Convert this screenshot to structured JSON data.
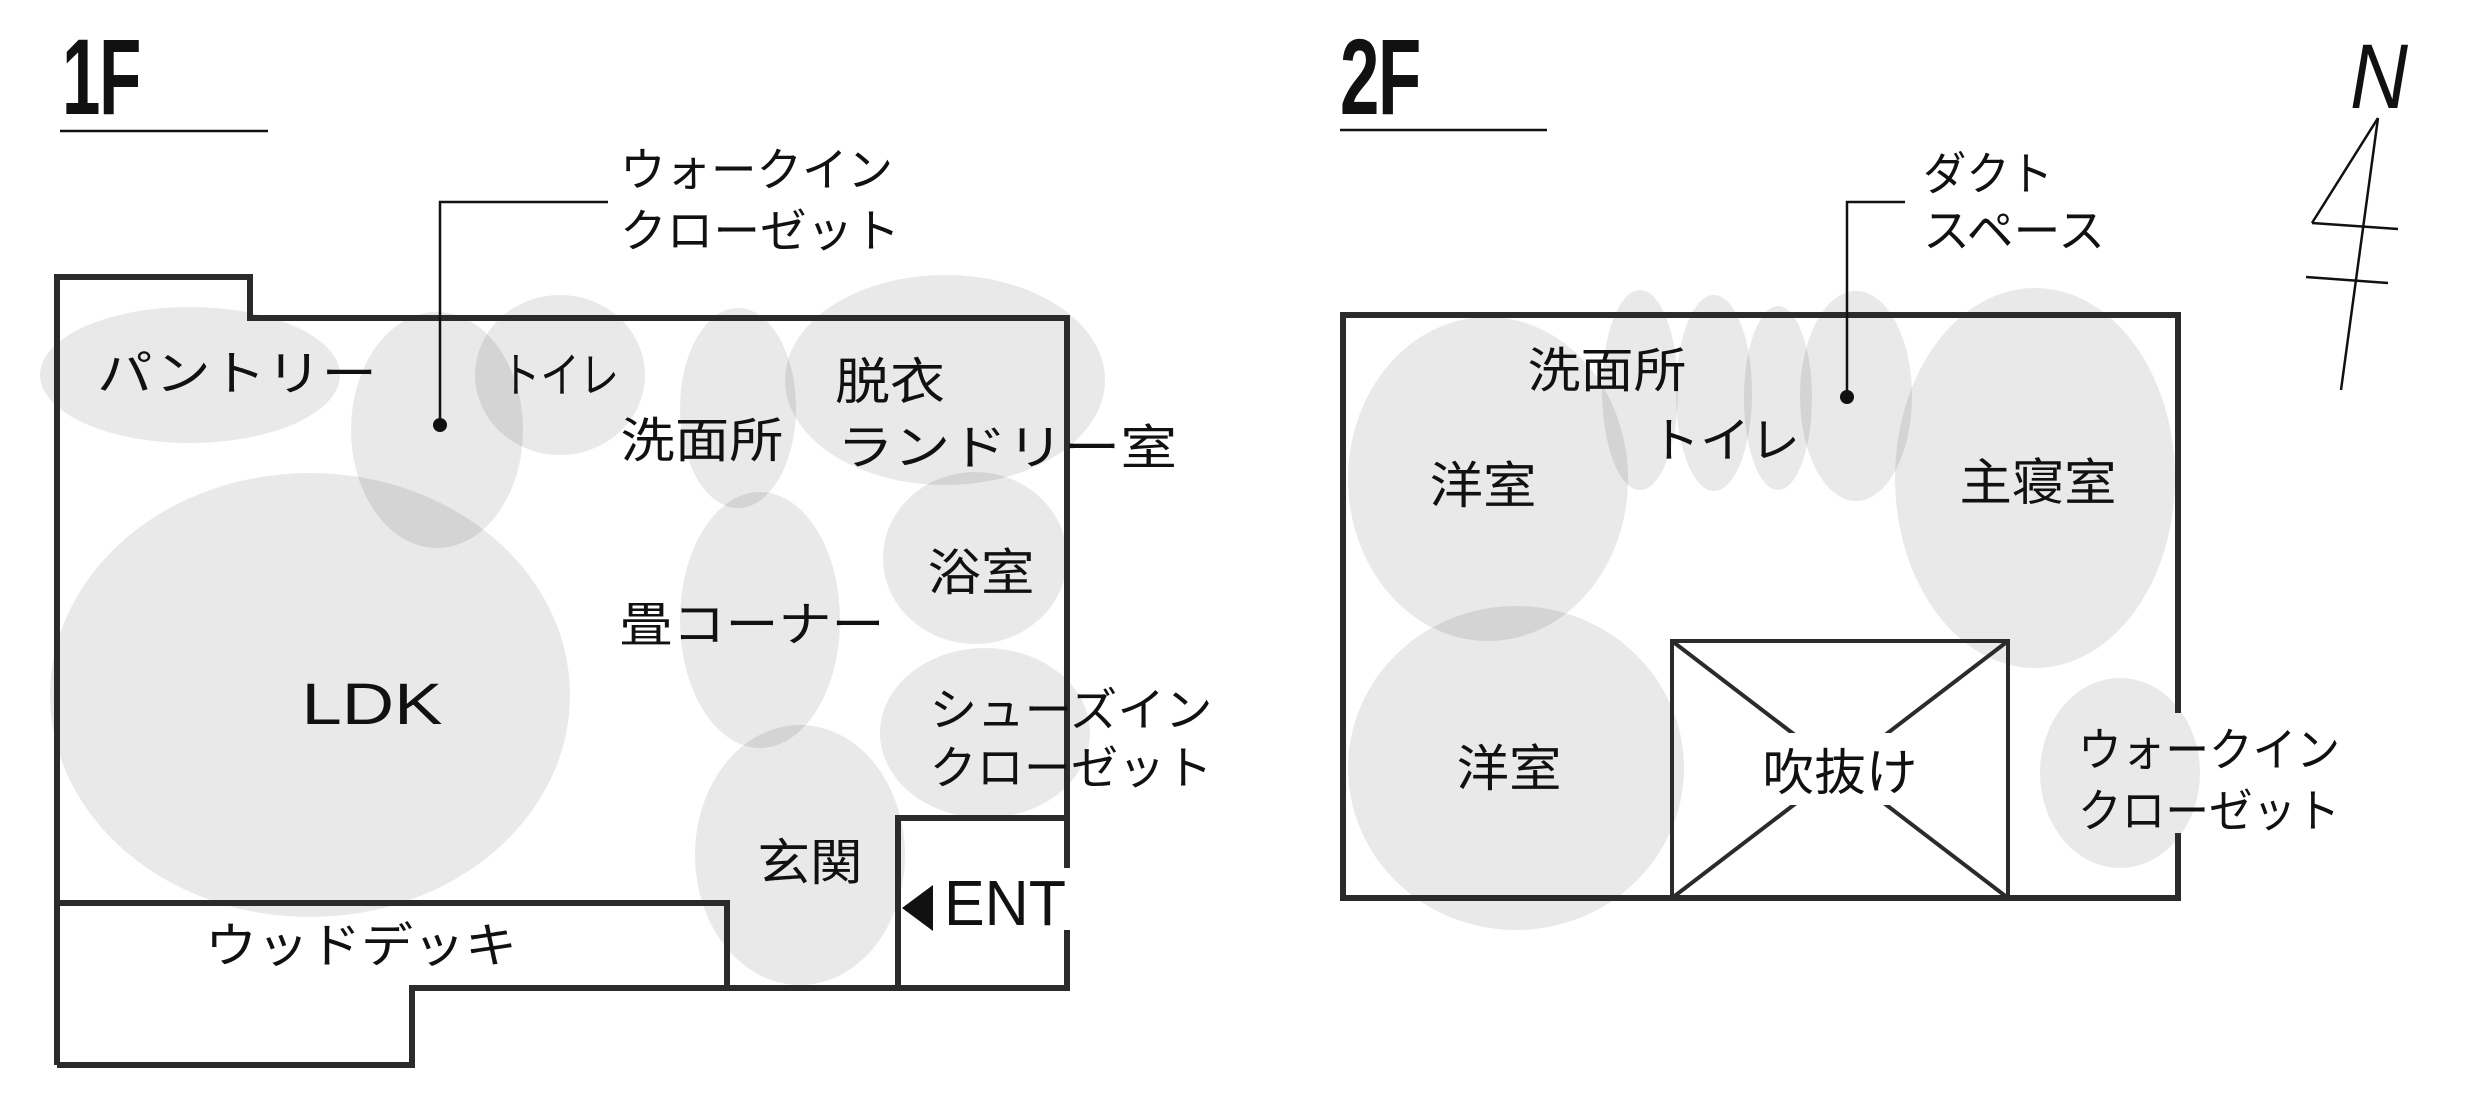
{
  "floor1": {
    "title": "1F",
    "callout_walk_in_closet": {
      "line1": "ウォークイン",
      "line2": "クローゼット"
    },
    "rooms": {
      "pantry": "パントリー",
      "toilet": "トイレ",
      "undressing_room": "脱衣",
      "laundry_room": "ランドリー室",
      "washroom": "洗面所",
      "bathroom": "浴室",
      "tatami_corner": "畳コーナー",
      "ldk": "LDK",
      "shoe_closet_line1": "シューズイン",
      "shoe_closet_line2": "クローゼット",
      "entrance_hall": "玄関",
      "wood_deck": "ウッドデッキ"
    },
    "entrance_label": "ENT"
  },
  "floor2": {
    "title": "2F",
    "callout_duct_space": {
      "line1": "ダクト",
      "line2": "スペース"
    },
    "rooms": {
      "washroom": "洗面所",
      "toilet": "トイレ",
      "western_room_upper": "洋室",
      "master_bedroom": "主寝室",
      "western_room_lower": "洋室",
      "atrium": "吹抜け",
      "walk_in_closet_line1": "ウォークイン",
      "walk_in_closet_line2": "クローゼット"
    }
  },
  "compass": {
    "north_label": "N"
  },
  "colors": {
    "wall": "#2b2b2b",
    "line": "#111111",
    "text": "#111111",
    "room_blob": "rgba(0,0,0,0.085)"
  }
}
